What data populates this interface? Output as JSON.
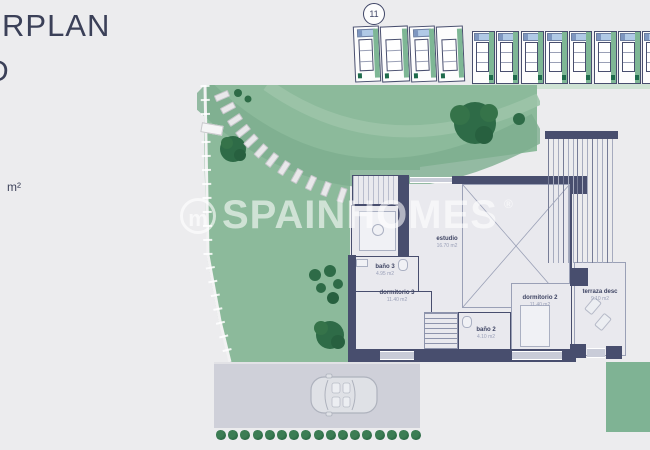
{
  "header": {
    "title_fragment": "RPLAN",
    "second_line_fragment": "D",
    "area_unit_fragment": "m²"
  },
  "site_plan": {
    "lot_badge": "11"
  },
  "watermark": {
    "logo_letter": "m",
    "brand": "SPAINHOMES",
    "registered_mark": "®"
  },
  "floor_plan": {
    "rooms": [
      {
        "id": "estudio",
        "name": "estudio",
        "area": "16.70 m2"
      },
      {
        "id": "bano3",
        "name": "baño 3",
        "area": "4.95 m2"
      },
      {
        "id": "dormitorio3",
        "name": "dormitorio 3",
        "area": "11.40 m2"
      },
      {
        "id": "bano2",
        "name": "baño 2",
        "area": "4.10 m2"
      },
      {
        "id": "dormitorio2",
        "name": "dormitorio 2",
        "area": "11.40 m2"
      },
      {
        "id": "terraza",
        "name": "terraza desc",
        "area": "9.10 m2"
      }
    ]
  },
  "colors": {
    "background": "#ececee",
    "title_navy": "#3b4058",
    "wall_navy": "#484e6e",
    "garden_green": "#8cba9b",
    "garden_band_dark": "#7dae8f",
    "tree_green": "#2d6b46",
    "pool_blue": "#b0c9e6",
    "plot_teal": "#1f6b4c",
    "driveway_gray": "#cfd0d9",
    "watermark_white": "rgba(255,255,255,0.58)"
  }
}
